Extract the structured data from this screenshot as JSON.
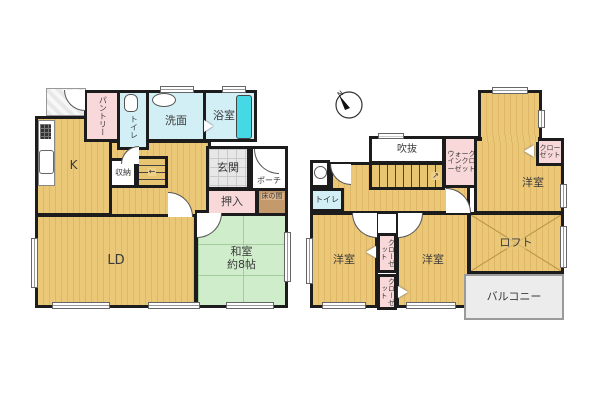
{
  "compass": {
    "north_label": "N"
  },
  "floor1": {
    "pantry": "パントリー",
    "toilet": "トイレ",
    "washroom": "洗面",
    "bathroom": "浴室",
    "kitchen": "K",
    "storage": "収納",
    "entrance": "玄関",
    "porch": "ポーチ",
    "closet": "押入",
    "alcove": "床の間",
    "living_dining": "LD",
    "japanese_room": "和室",
    "japanese_room_size": "約8帖"
  },
  "floor2": {
    "open_void": "吹抜",
    "walk_in_closet": "ウォークインクローゼット",
    "closet_main": "クローゼット",
    "bedroom_main": "洋室",
    "toilet": "トイレ",
    "bedroom_left": "洋室",
    "bedroom_center": "洋室",
    "closet_upper": "クローゼット",
    "closet_lower": "クローゼット",
    "loft": "ロフト",
    "balcony": "バルコニー"
  },
  "icons": {
    "stairs_arrow_1f": "←",
    "stairs_arrow_2f": "↗"
  },
  "colors": {
    "wall": "#1c1c1c",
    "wood_floor": "#eac87c",
    "tatami_green": "#cfeccb",
    "wet_area_blue": "#d2eff6",
    "closet_pink": "#f8d8d8",
    "bathtub_cyan": "#45d9e6",
    "entrance_tile": "#e7e7e7",
    "balcony_gray": "#ececec",
    "alcove_wood": "#c49a6c"
  }
}
